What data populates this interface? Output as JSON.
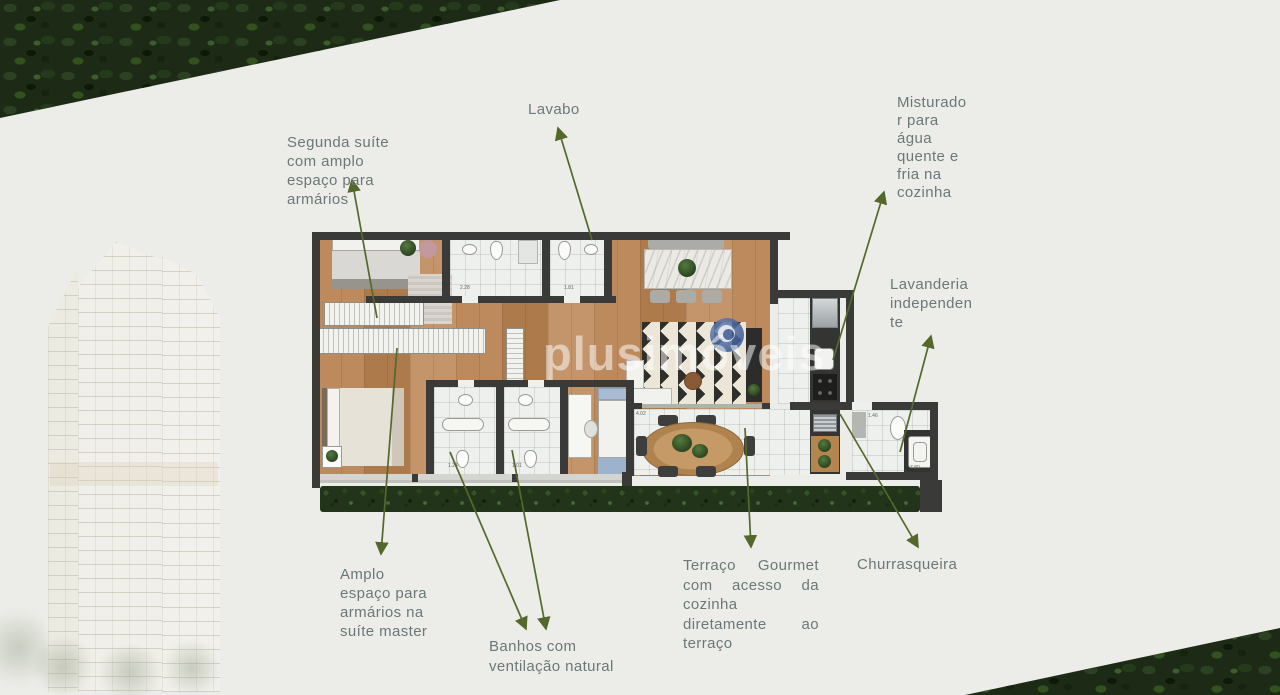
{
  "colors": {
    "background": "#ecede8",
    "arrow_green": "#55682c",
    "label_text": "#6b7877",
    "wall": "#3a3a39",
    "wood_floor": "#b5835a",
    "watermark_blue": "#43619c"
  },
  "watermark": {
    "text": "plusimóveis"
  },
  "annotations": {
    "lavabo": {
      "lines": [
        "Lavabo"
      ]
    },
    "segunda_suite": {
      "lines": [
        "Segunda suíte",
        "com amplo",
        "espaço para",
        "armários"
      ]
    },
    "misturador": {
      "lines": [
        "Misturado",
        "r para",
        "água",
        "quente e",
        "fria na",
        "cozinha"
      ]
    },
    "lavanderia": {
      "lines": [
        "Lavanderia",
        "independen",
        "te"
      ]
    },
    "amplo": {
      "lines": [
        "Amplo",
        "espaço para",
        "armários na",
        "suíte master"
      ]
    },
    "banhos": {
      "lines": [
        "Banhos com",
        "ventilação natural"
      ]
    },
    "terraco": {
      "lines": [
        "Terraço Gourmet",
        "com acesso da",
        "cozinha",
        "diretamente ao",
        "terraço"
      ]
    },
    "churrasqueira": {
      "lines": [
        "Churrasqueira"
      ]
    }
  },
  "plan": {
    "dimensions": [
      "2.28",
      "1.81",
      "1.24",
      "1.01",
      "1.46",
      "7.80",
      "4.02"
    ]
  }
}
